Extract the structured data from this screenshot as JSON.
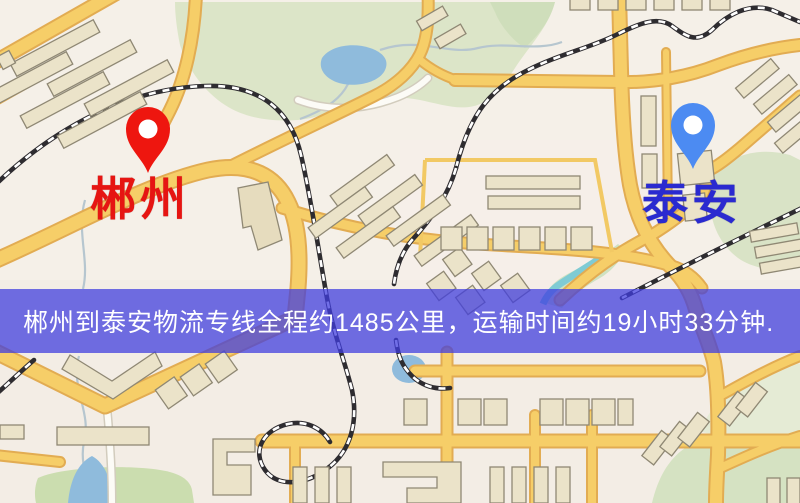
{
  "banner": {
    "text": "郴州到泰安物流专线全程约1485公里，运输时间约19小时33分钟.",
    "background_color": "#403DDE",
    "text_color": "#FFFFFF"
  },
  "markers": {
    "origin": {
      "label": "郴州",
      "pin_color": "#EE160F",
      "label_color": "#E61512"
    },
    "destination": {
      "label": "泰安",
      "pin_color": "#4C8BF2",
      "label_color": "#2A2AD0"
    }
  },
  "map_colors": {
    "background": "#F5F0E8",
    "road_fill": "#F6CE68",
    "road_casing": "#E2AC52",
    "minor_road": "#FCFBF6",
    "park_green": "#DCE5C8",
    "water_blue": "#8FBBDC",
    "railway_dark": "#2E2C30",
    "building_fill": "#EBE3C9"
  }
}
